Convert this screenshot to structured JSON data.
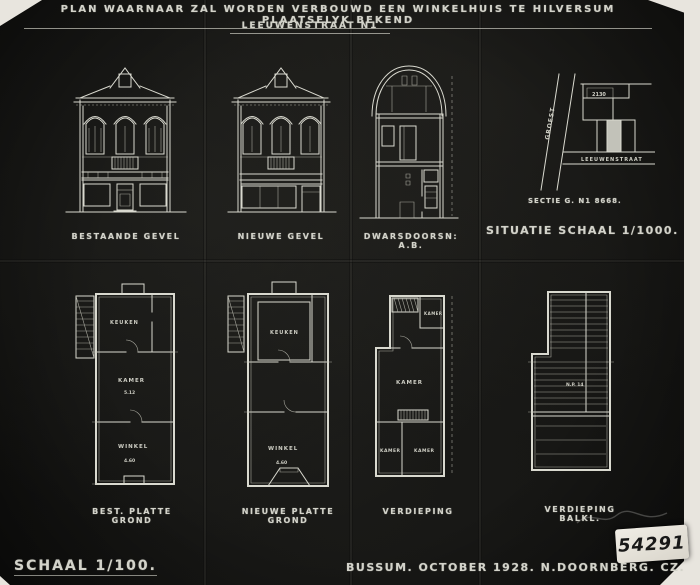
{
  "title": {
    "line1": "PLAN WAARNAAR ZAL WORDEN VERBOUWD EEN WINKELHUIS TE HILVERSUM PLAATSELYK BEKEND",
    "line2": "LEEUWENSTRAAT N1"
  },
  "top_row": {
    "bestaande_gevel_label": "BESTAANDE GEVEL",
    "nieuwe_gevel_label": "NIEUWE GEVEL",
    "dwarsdoorsnede_label": "DWARSDOORSN: A.B.",
    "sectie_note": "SECTIE G. N1 8668.",
    "situatie_label": "SITUATIE  SCHAAL 1/1000."
  },
  "situatie_map": {
    "street_diagonal": "GROEST",
    "street_bottom": "LEEUWENSTRAAT",
    "parcel_number": "2130"
  },
  "bottom_row": {
    "plan1_label": "BEST. PLATTE GROND",
    "plan2_label": "NIEUWE PLATTE GROND",
    "plan3_label": "VERDIEPING",
    "plan4_label": "VERDIEPING BALKL."
  },
  "rooms": {
    "plan1": {
      "top": "KEUKEN",
      "middle": "KAMER",
      "middle_dim": "5.12",
      "bottom": "WINKEL",
      "bottom_dim": "4.60"
    },
    "plan2": {
      "top": "KEUKEN",
      "bottom": "WINKEL",
      "bottom_dim": "4.60"
    },
    "plan3": {
      "top_right": "KAMER",
      "middle": "KAMER",
      "bottom_left": "KAMER",
      "bottom_right": "KAMER"
    },
    "plan4": {
      "note": "N.P. 14"
    }
  },
  "footer": {
    "scale": "SCHAAL 1/100.",
    "credit": "BUSSUM. OCTOBER 1928. N.DOORNBERG. CZ."
  },
  "sticker": {
    "number": "54291"
  }
}
